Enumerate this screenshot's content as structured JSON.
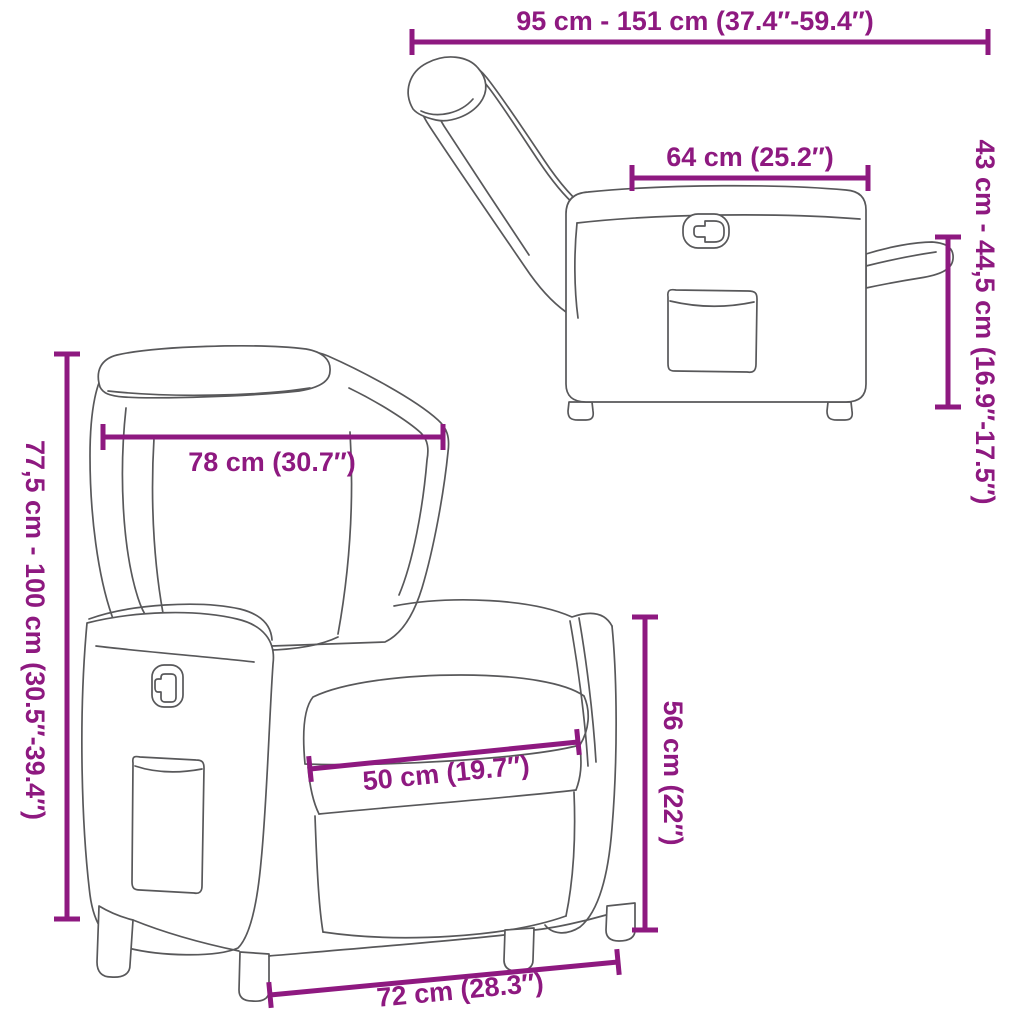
{
  "figure": {
    "kind": "product dimension diagram",
    "subject": "reclining chair line drawing shown in two views"
  },
  "colors": {
    "dimension_annotation": "#8E1980",
    "line_art": "#58585A",
    "background": "#FFFFFF"
  },
  "illustrations": {
    "side_view": "Reclining chair side view with backrest reclined and footrest extended",
    "front_view": "Reclining chair front three-quarter view"
  },
  "dims": {
    "reclined_length": {
      "label": "95 cm - 151 cm (37.4″-59.4″)"
    },
    "top_depth": {
      "label": "64 cm (25.2″)"
    },
    "footrest_height": {
      "label": "43 cm - 44,5 cm (16.9″-17.5″)"
    },
    "total_height": {
      "label": "77,5 cm - 100 cm (30.5″-39.4″)"
    },
    "backrest_width": {
      "label": "78 cm (30.7″)"
    },
    "seat_width": {
      "label": "50 cm (19.7″)"
    },
    "seat_height": {
      "label": "56 cm (22″)"
    },
    "base_width": {
      "label": "72 cm (28.3″)"
    }
  }
}
